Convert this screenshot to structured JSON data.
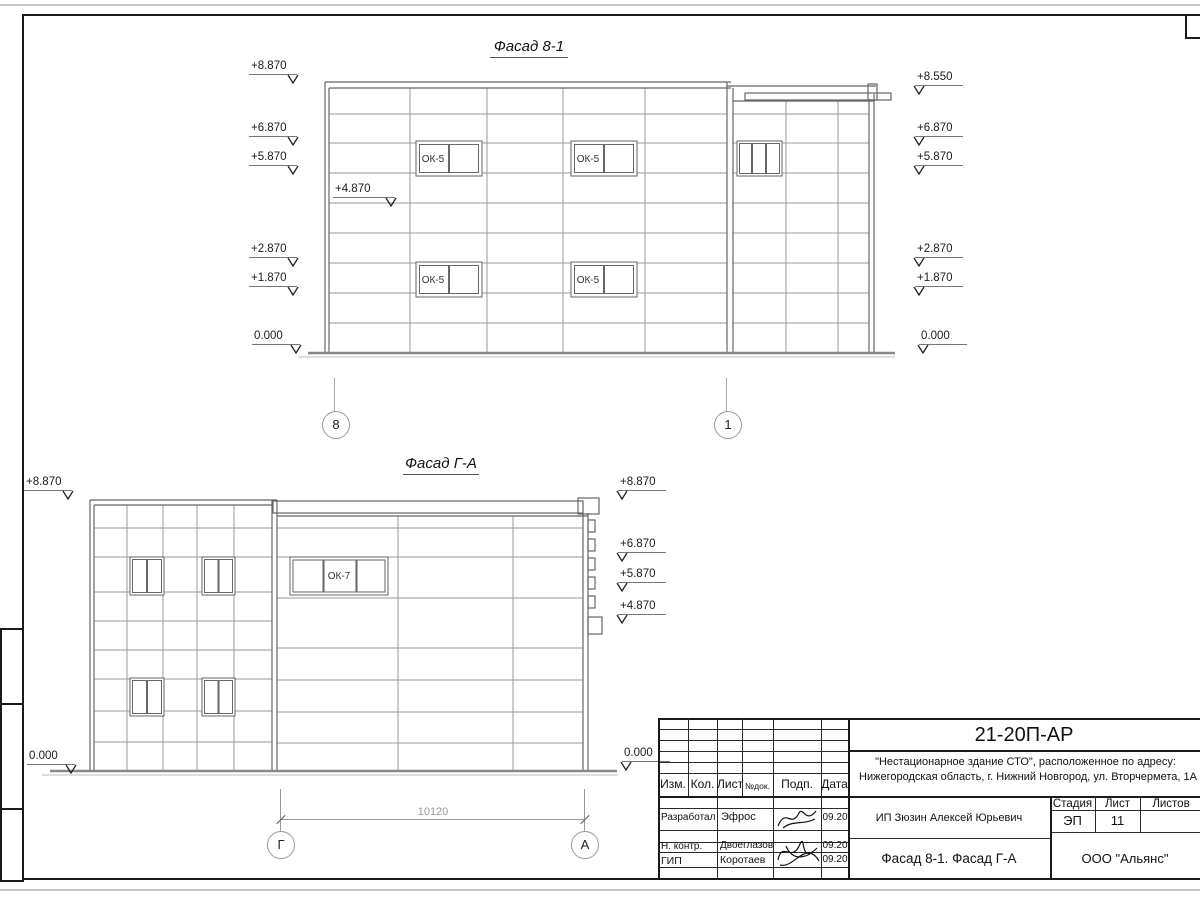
{
  "figures": {
    "facade1": {
      "title": "Фасад 8-1",
      "window_label": "ОК-5",
      "marks_left": [
        "+8.870",
        "+6.870",
        "+5.870",
        "+2.870",
        "+1.870",
        "0.000"
      ],
      "mark_inner": "+4.870",
      "marks_right": [
        "+8.550",
        "+6.870",
        "+5.870",
        "+2.870",
        "+1.870",
        "0.000"
      ],
      "grid_left": "8",
      "grid_right": "1"
    },
    "facade2": {
      "title": "Фасад Г-А",
      "window_label": "ОК-7",
      "marks_left": [
        "+8.870",
        "0.000"
      ],
      "marks_right": [
        "+8.870",
        "+6.870",
        "+5.870",
        "+4.870",
        "0.000"
      ],
      "dimension": "10120",
      "grid_left": "Г",
      "grid_right": "А"
    }
  },
  "titleblock": {
    "doc_number": "21-20П-АР",
    "project_line1": "\"Нестационарное здание СТО\", расположенное по адресу:",
    "project_line2": "Нижегородская область, г. Нижний Новгород, ул. Вторчермета, 1А",
    "header": [
      "Изм.",
      "Кол.",
      "Лист",
      "№док.",
      "Подп.",
      "Дата"
    ],
    "rows": [
      {
        "role": "Разработал",
        "name": "Эфрос",
        "date": "09.20"
      },
      {
        "role": "Н. контр.",
        "name": "Двоеглазов",
        "date": "09.20"
      },
      {
        "role": "ГИП",
        "name": "Коротаев",
        "date": "09.20"
      }
    ],
    "client": "ИП Зюзин Алексей Юрьевич",
    "stage_label": "Стадия",
    "sheet_label": "Лист",
    "sheets_label": "Листов",
    "stage": "ЭП",
    "sheet_number": "11",
    "drawing_title": "Фасад 8-1. Фасад Г-А",
    "organization": "ООО \"Альянс\""
  }
}
